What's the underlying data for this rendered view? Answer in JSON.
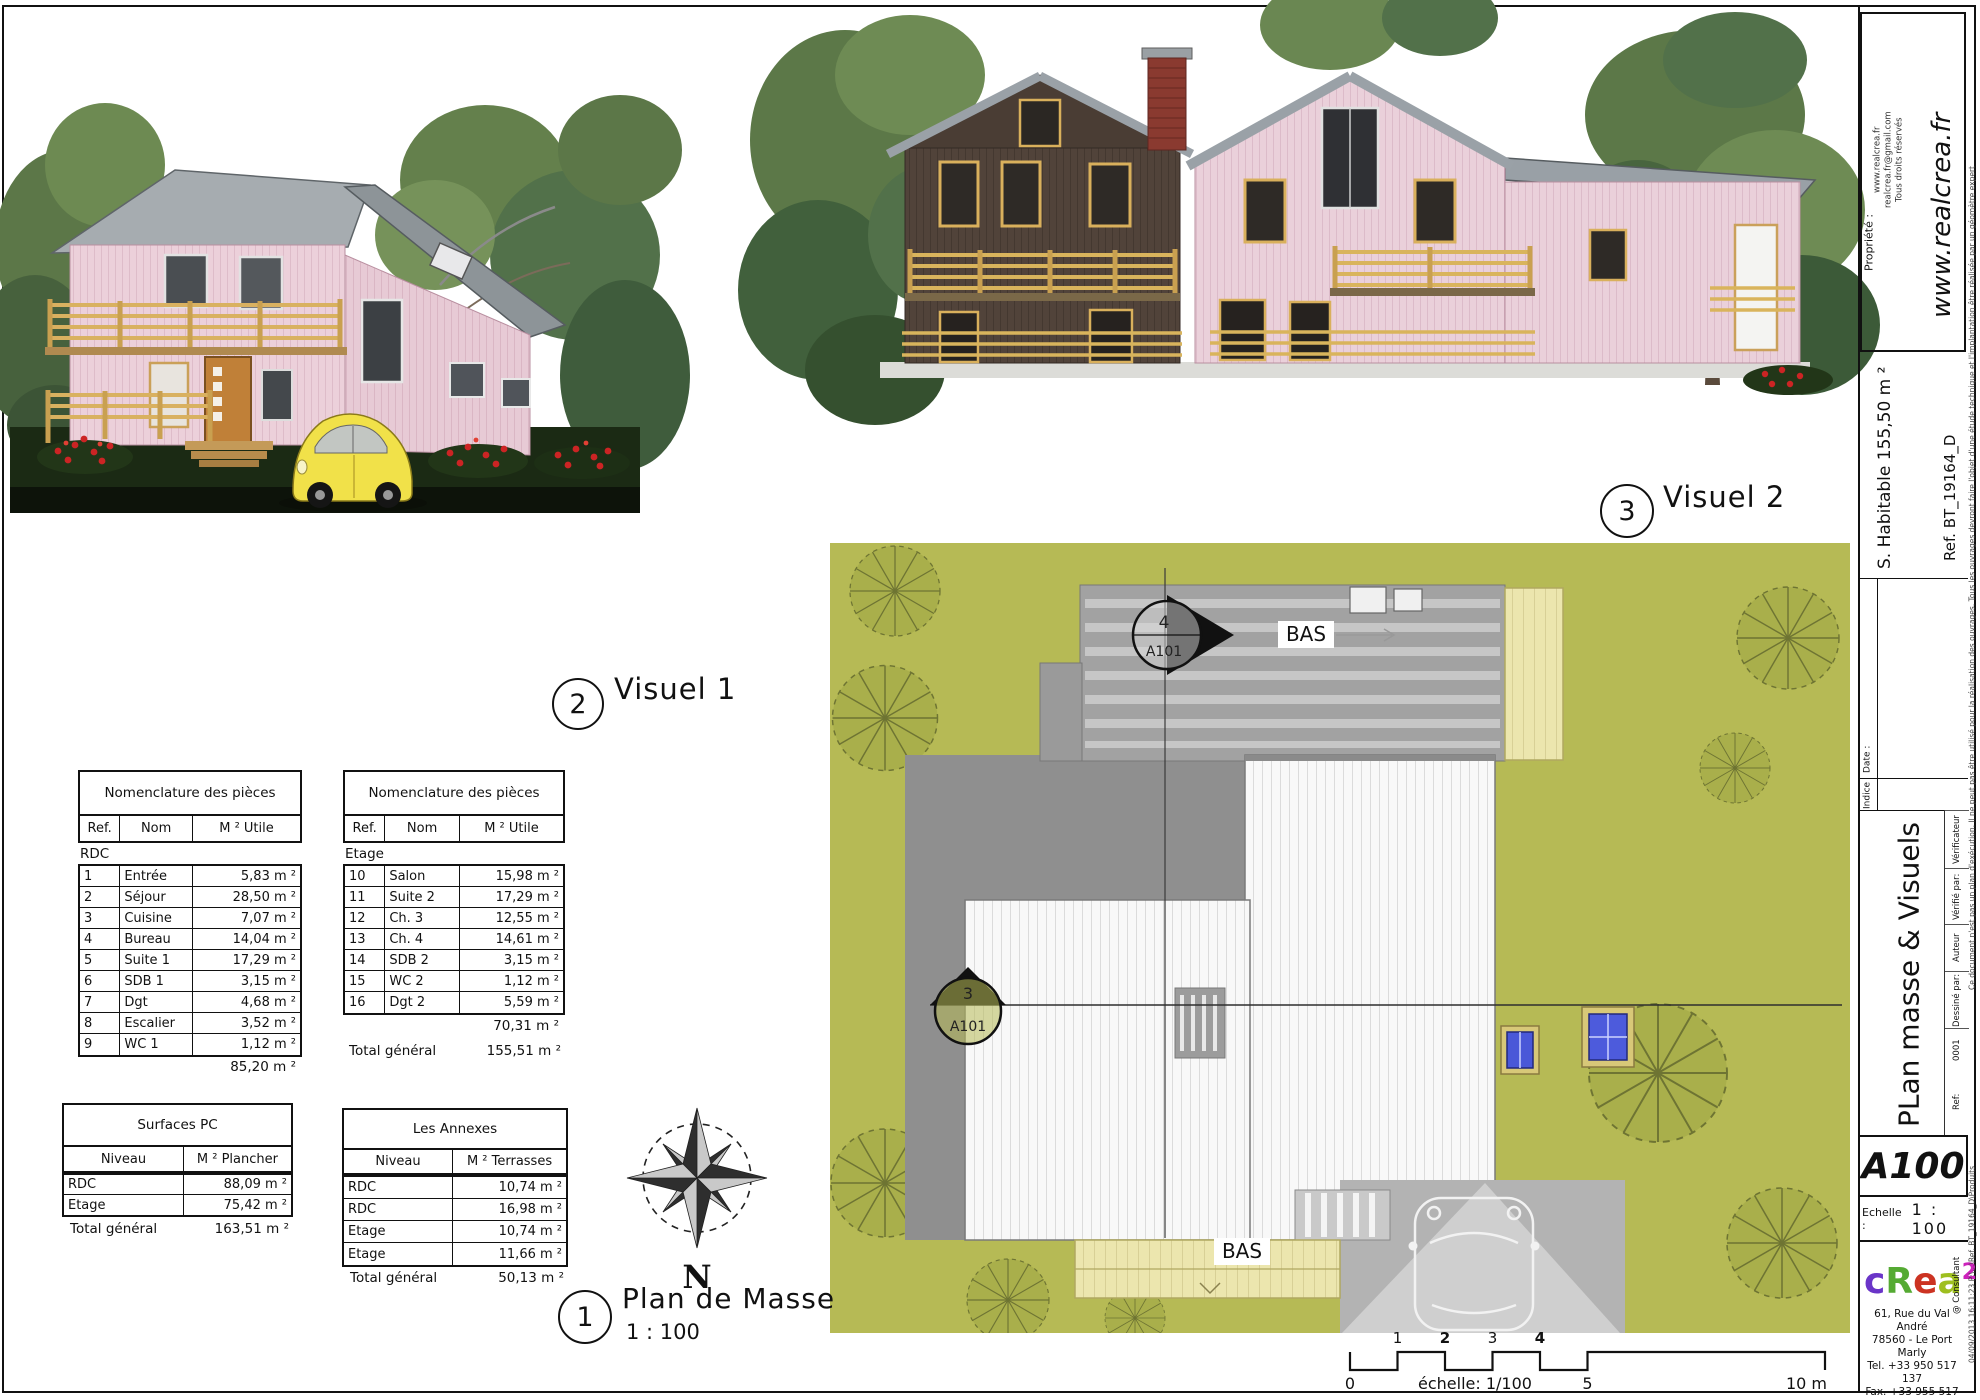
{
  "callouts": {
    "visuel1": {
      "number": "2",
      "label": "Visuel 1"
    },
    "visuel2": {
      "number": "3",
      "label": "Visuel 2"
    },
    "plan_masse": {
      "number": "1",
      "label": "Plan de Masse",
      "scale": "1 : 100"
    }
  },
  "north_label": "N",
  "site_plan": {
    "marker_top": {
      "number": "4",
      "ref": "A101"
    },
    "marker_left": {
      "number": "3",
      "ref": "A101"
    },
    "bas_top": "BAS",
    "bas_bottom": "BAS",
    "background_color": "#b6ba55"
  },
  "scale_bar": {
    "labels_above": [
      "1",
      "2",
      "3",
      "4"
    ],
    "label_zero": "0",
    "label_mid": "5",
    "label_end": "10 m",
    "caption": "échelle: 1/100"
  },
  "tables": {
    "rdc": {
      "title": "Nomenclature des pièces",
      "cols": [
        "Ref.",
        "Nom",
        "M ² Utile"
      ],
      "group": "RDC",
      "rows": [
        [
          "1",
          "Entrée",
          "5,83 m ²"
        ],
        [
          "2",
          "Séjour",
          "28,50 m ²"
        ],
        [
          "3",
          "Cuisine",
          "7,07 m ²"
        ],
        [
          "4",
          "Bureau",
          "14,04 m ²"
        ],
        [
          "5",
          "Suite 1",
          "17,29 m ²"
        ],
        [
          "6",
          "SDB 1",
          "3,15 m ²"
        ],
        [
          "7",
          "Dgt",
          "4,68 m ²"
        ],
        [
          "8",
          "Escalier",
          "3,52 m ²"
        ],
        [
          "9",
          "WC 1",
          "1,12 m ²"
        ]
      ],
      "subtotal": "85,20 m ²"
    },
    "etage": {
      "title": "Nomenclature des pièces",
      "cols": [
        "Ref.",
        "Nom",
        "M ² Utile"
      ],
      "group": "Etage",
      "rows": [
        [
          "10",
          "Salon",
          "15,98 m ²"
        ],
        [
          "11",
          "Suite 2",
          "17,29 m ²"
        ],
        [
          "12",
          "Ch. 3",
          "12,55 m ²"
        ],
        [
          "13",
          "Ch. 4",
          "14,61 m ²"
        ],
        [
          "14",
          "SDB 2",
          "3,15 m ²"
        ],
        [
          "15",
          "WC 2",
          "1,12 m ²"
        ],
        [
          "16",
          "Dgt 2",
          "5,59 m ²"
        ]
      ],
      "subtotal": "70,31 m ²",
      "total_label": "Total général",
      "total": "155,51 m ²"
    },
    "surfaces": {
      "title": "Surfaces PC",
      "cols": [
        "Niveau",
        "M ² Plancher"
      ],
      "rows": [
        [
          "RDC",
          "88,09 m ²"
        ],
        [
          "Etage",
          "75,42 m ²"
        ]
      ],
      "total_label": "Total général",
      "total": "163,51 m ²"
    },
    "annexes": {
      "title": "Les Annexes",
      "cols": [
        "Niveau",
        "M ² Terrasses"
      ],
      "rows": [
        [
          "RDC",
          "10,74 m ²"
        ],
        [
          "RDC",
          "16,98 m ²"
        ],
        [
          "Etage",
          "10,74 m ²"
        ],
        [
          "Etage",
          "11,66 m ²"
        ]
      ],
      "total_label": "Total général",
      "total": "50,13 m ²"
    }
  },
  "title_block": {
    "propriete_label": "Propriété :",
    "site": "www.realcrea.fr",
    "contact_lines": [
      "www.realcrea.fr",
      "realcrea.fr@gmail.com",
      "Tous droits réservés"
    ],
    "habitable": "S. Habitable 155,50 m ²",
    "reference": "Ref. BT_19164_D",
    "date_label": "Date :",
    "indice_label": "Indice",
    "sheet_title": "PLan masse & Visuels",
    "meta": {
      "checked_value": "Vérificateur",
      "checked_label": "Vérifié par:",
      "drawn_value": "Auteur",
      "drawn_label": "Dessiné par:",
      "ref_value": "0001",
      "ref_label": "Ref:"
    },
    "sheet_number": "A100",
    "scale_label": "Echelle :",
    "scale_value": "1 : 100",
    "logo": {
      "c": "c",
      "R": "R",
      "e": "e",
      "a": "a",
      "sup": "2",
      "L": "L",
      "consultant": "@ Consultant",
      "colors": {
        "c": "#6a35c8",
        "R": "#55aa33",
        "e": "#cc3322",
        "a": "#9ebf1f",
        "sup": "#cc22bb",
        "L": "#22aacc"
      }
    },
    "address_lines": [
      "61, Rue du Val André",
      "78560 - Le Port Marly",
      "Tel. +33 950 517 137",
      "Fax. +33 955 517 137",
      "www.realcrea.fr",
      "realcrea.fr@gmail.com"
    ],
    "disclaimer": "Ce document n'est pas un plan d'exécution. Il ne peut pas être utilisé pour la réalisation des ouvrages. Tous les ouvrages devront faire l'objet d'une étude technique et l'implantation être réalisée par un géomètre expert",
    "file_info": "04/09/2013 16:11:23   P:\\...\\Ref. BT_19164_D\\Produits"
  }
}
